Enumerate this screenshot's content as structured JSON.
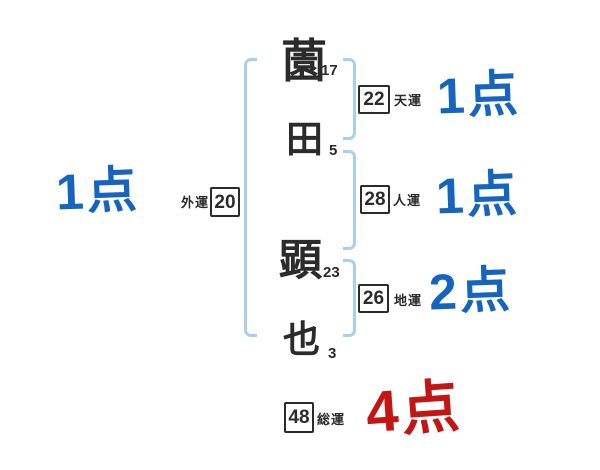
{
  "colors": {
    "background": "#ffffff",
    "ink": "#2b2b2b",
    "bracket_blue": "#a6d0ec",
    "score_blue": "#1565c0",
    "score_red": "#c41515"
  },
  "name": {
    "characters": [
      {
        "char": "薗",
        "strokes": "17"
      },
      {
        "char": "田",
        "strokes": "5"
      },
      {
        "char": "顕",
        "strokes": "23"
      },
      {
        "char": "也",
        "strokes": "3"
      }
    ]
  },
  "fortunes": {
    "gaiun": {
      "label": "外運",
      "value": "20",
      "score": "1点"
    },
    "tenun": {
      "label": "天運",
      "value": "22",
      "score": "1点"
    },
    "jinun": {
      "label": "人運",
      "value": "28",
      "score": "1点"
    },
    "chiun": {
      "label": "地運",
      "value": "26",
      "score": "2点"
    },
    "souun": {
      "label": "総運",
      "value": "48",
      "score": "4点"
    }
  }
}
